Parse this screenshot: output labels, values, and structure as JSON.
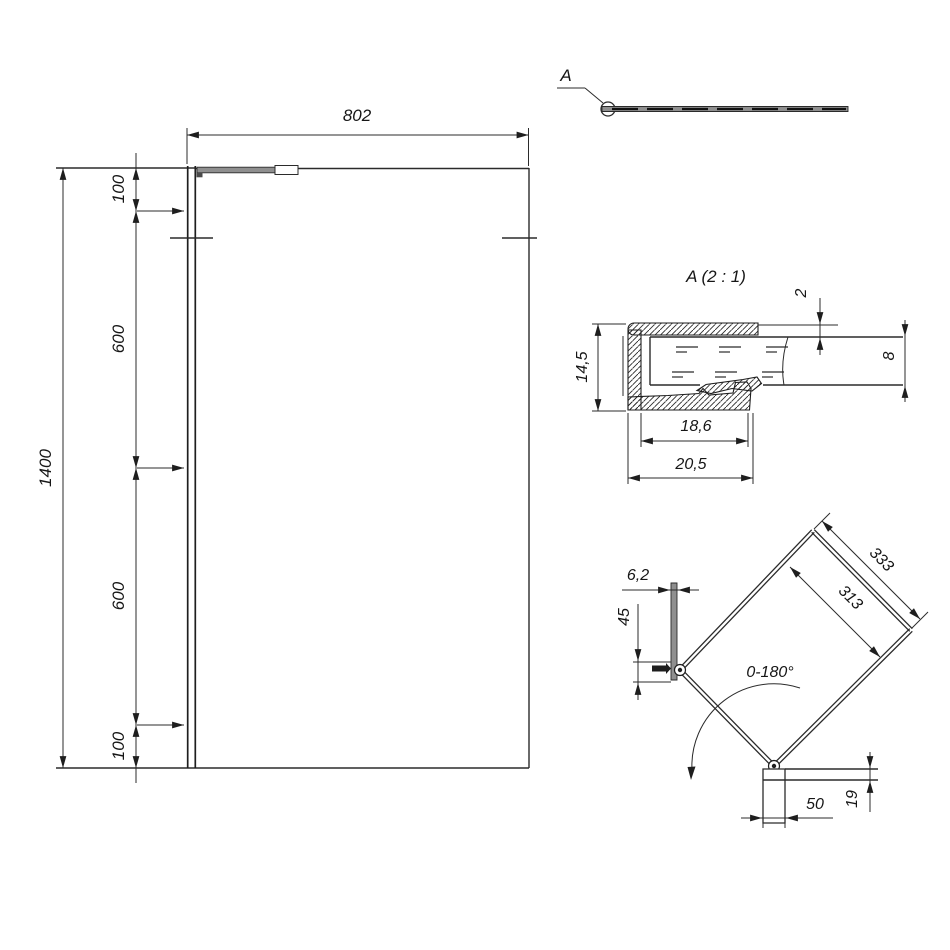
{
  "front_view": {
    "overall_width": "802",
    "overall_height": "1400",
    "left_chain": [
      "100",
      "600",
      "600",
      "100"
    ]
  },
  "plan_view": {
    "detail_callout": "A"
  },
  "detail_view": {
    "title": "A (2 : 1)",
    "top_gap": "2",
    "profile_depth": "14,5",
    "glass_thickness": "8",
    "inner_width": "18,6",
    "outer_width": "20,5"
  },
  "swing_view": {
    "wall_profile_width": "6,2",
    "wall_bracket_height": "45",
    "arm_outer_length": "333",
    "arm_hole_spacing": "313",
    "swing_angle": "0-180°",
    "glass_clamp_length": "50",
    "glass_clamp_height": "19"
  },
  "colors": {
    "line": "#2b2b2b",
    "metal_gray": "#8f8f8f",
    "background": "#ffffff"
  }
}
